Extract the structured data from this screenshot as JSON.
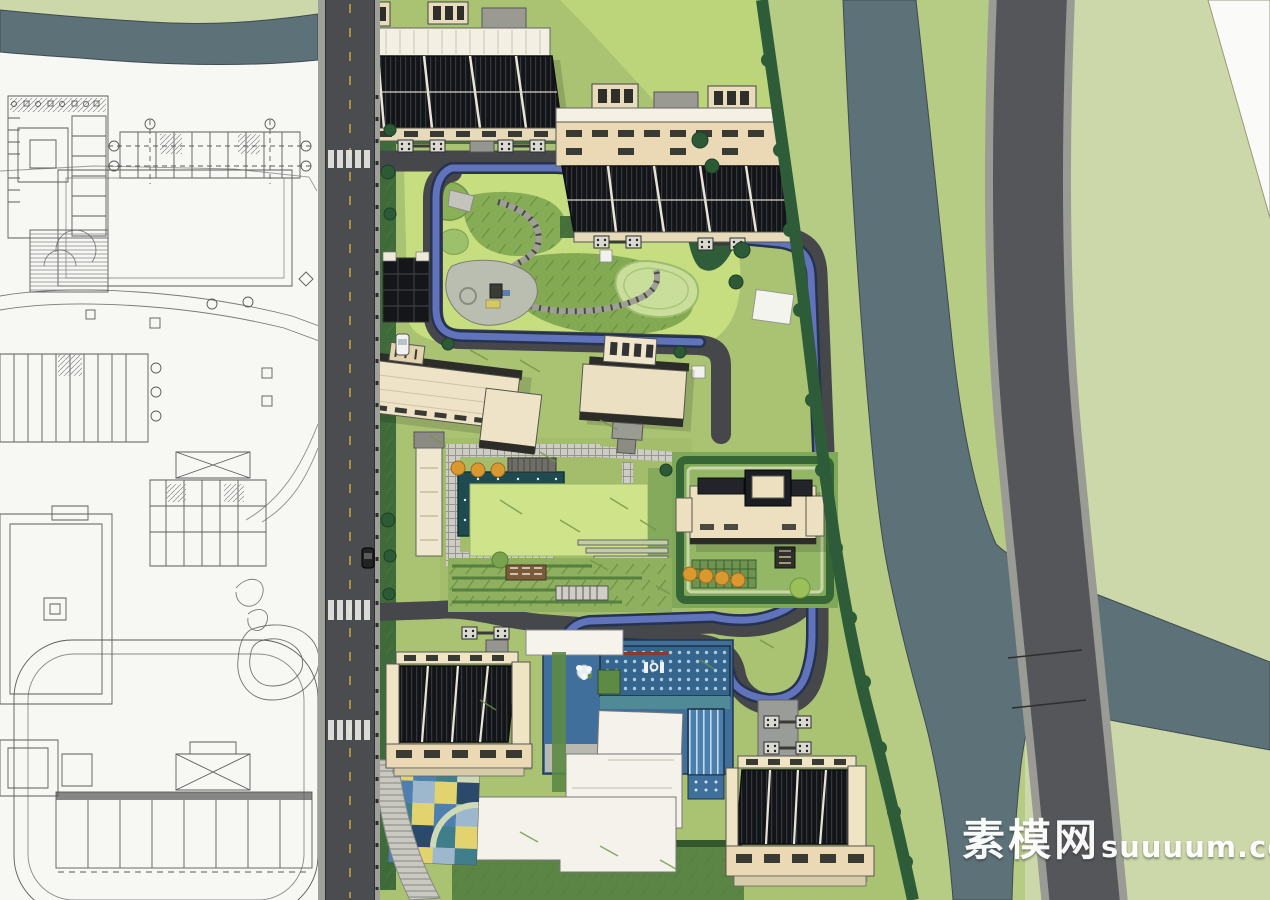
{
  "watermark": {
    "site_name_cjk": "素模网",
    "site_domain": "suuuum.com"
  },
  "palette": {
    "cad_background": "#f7f7f4",
    "cad_linework": "#5b5b5b",
    "road_asphalt": "#4b4c4f",
    "road_curb": "#a0a09b",
    "lane_marking_yellow": "#c8a63c",
    "river_water": "#5d7179",
    "riverbank_green": "#b6cc85",
    "outer_meadow_green": "#ccd8a9",
    "site_base_green": "#a9c372",
    "park_lawn_green": "#c6dd80",
    "courtyard_lawn_green": "#cfe38a",
    "dense_tree_green": "#2e5c38",
    "jogging_track_blue": "#6073bb",
    "track_edge_navy": "#26334f",
    "building_tan": "#e8dcbc",
    "building_cream": "#f3efe2",
    "roof_dark": "#131417",
    "pool_water_blue": "#3f6f9a",
    "pool_tile_teal": "#4f8a96",
    "autumn_tree_orange": "#d9992f",
    "playground_yellow": "#e3d36e",
    "watermark_white": "#ffffff"
  }
}
